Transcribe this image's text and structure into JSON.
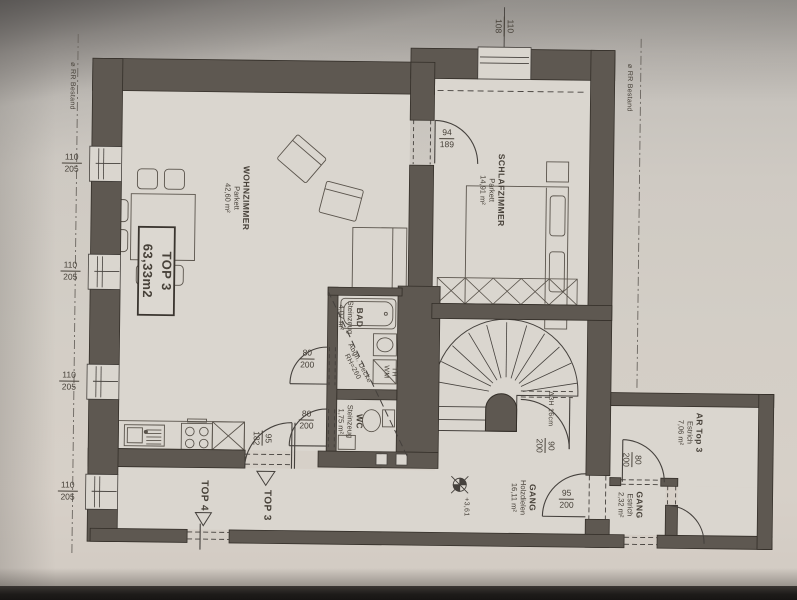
{
  "style": {
    "ink": "#474139",
    "wall_fill": "#5e5851",
    "paper": "#d2cdc5",
    "floor": "#dad6cf"
  },
  "unit_box": {
    "name": "TOP 3",
    "area": "63,33m2"
  },
  "rooms": {
    "wohnzimmer": {
      "name": "WOHNZIMMER",
      "floor": "Parkett",
      "area": "42,60 m²"
    },
    "schlafzimmer": {
      "name": "SCHLAFZIMMER",
      "floor": "Parkett",
      "area": "14,91 m²"
    },
    "bad": {
      "name": "BAD",
      "floor": "Steinzeug",
      "area": "4,07 m²"
    },
    "wc": {
      "name": "WC",
      "floor": "Steinzeug",
      "area": "1,75 m²"
    },
    "gang": {
      "name": "GANG",
      "floor": "Holzdielen",
      "area": "16,11 m²"
    },
    "ar_top3": {
      "name": "AR Top 3",
      "floor": "Estrich",
      "area": "7,06 m²"
    },
    "gang_klein": {
      "name": "GANG",
      "floor": "Estrich",
      "area": "2,32 m²"
    }
  },
  "openings": {
    "window_left": {
      "w": "110",
      "h": "205"
    },
    "window_top": {
      "w": "110",
      "h": "108"
    },
    "door_schlafzimmer": {
      "w": "94",
      "h": "189"
    },
    "door_bad": {
      "w": "80",
      "h": "200"
    },
    "door_wc": {
      "w": "80",
      "h": "200"
    },
    "door_wohnung": {
      "w": "95",
      "h": "182"
    },
    "door_stiege": {
      "w": "90",
      "h": "200"
    },
    "door_gang": {
      "w": "95",
      "h": "200"
    },
    "door_ar": {
      "w": "80",
      "h": "200"
    }
  },
  "annotations": {
    "suspended_ceiling": [
      "Abgh. Decke",
      "RH=260"
    ],
    "stair_note": "Δ3H 16cm",
    "level": "+3,61",
    "boiler": "TH",
    "washer": "WM",
    "unit_top3": "TOP 3",
    "unit_top4": "TOP 4",
    "bestand_note": "⌀ RR Bestand"
  }
}
